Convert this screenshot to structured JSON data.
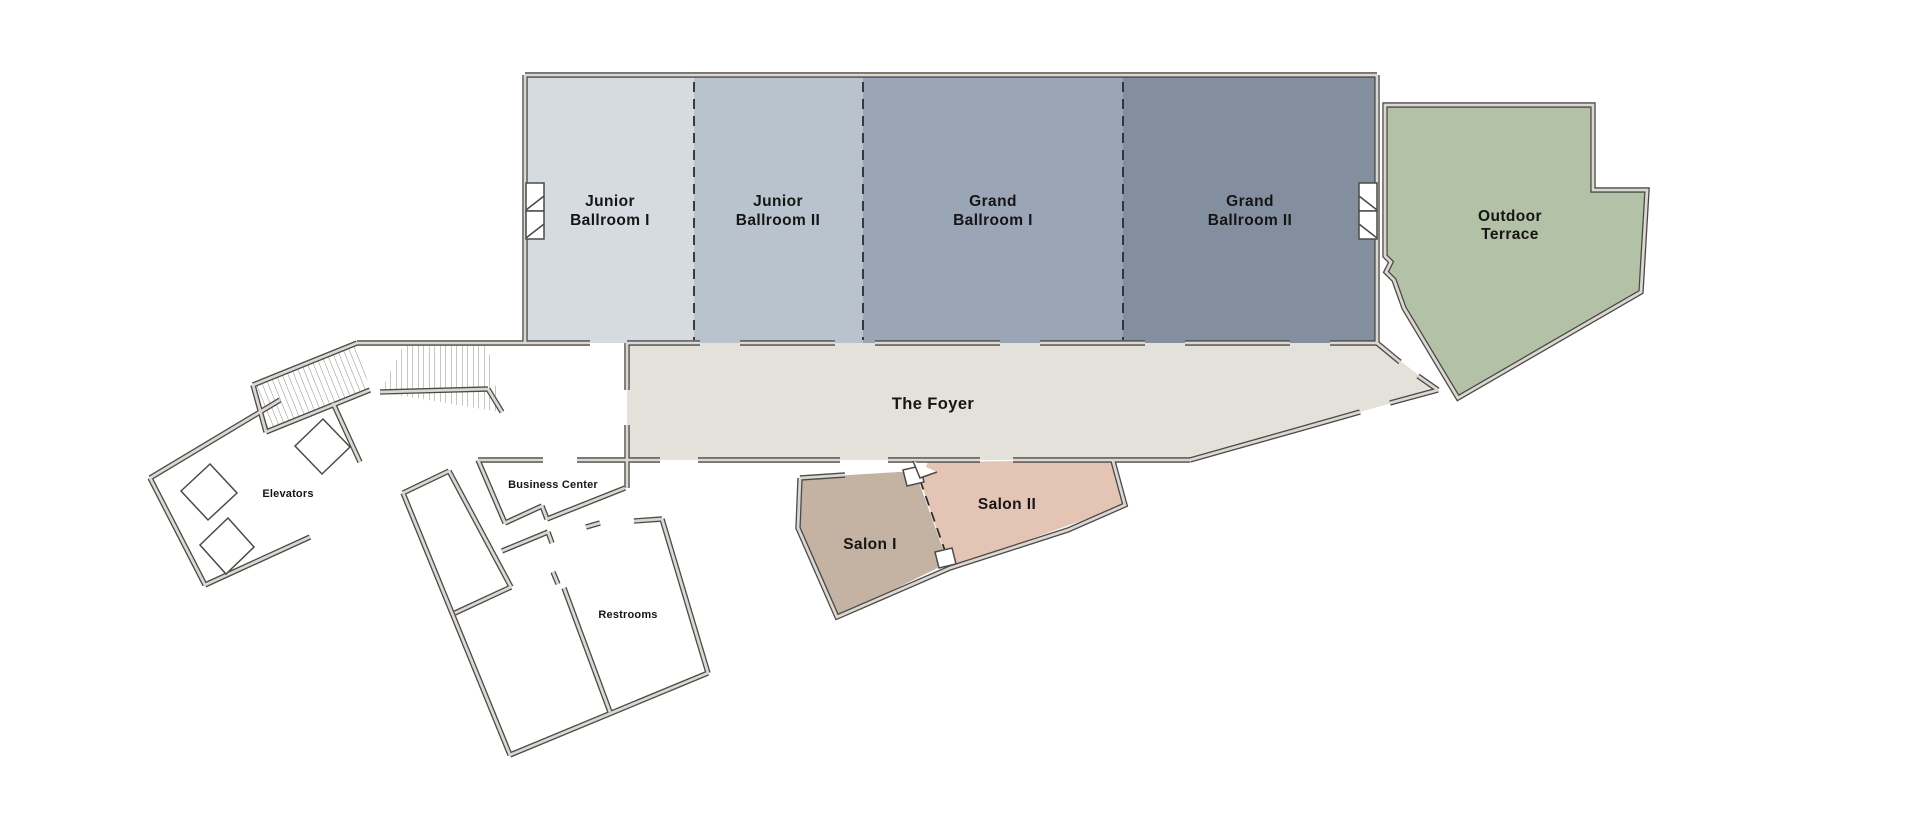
{
  "floor_plan": {
    "title": "Hotel event level floor plan",
    "rooms": {
      "junior_ballroom_1": {
        "label_line1": "Junior",
        "label_line2": "Ballroom I",
        "color": "#d6dbe2"
      },
      "junior_ballroom_2": {
        "label_line1": "Junior",
        "label_line2": "Ballroom II",
        "color": "#b9c3cd"
      },
      "grand_ballroom_1": {
        "label_line1": "Grand",
        "label_line2": "Ballroom I",
        "color": "#9aa5b5"
      },
      "grand_ballroom_2": {
        "label_line1": "Grand",
        "label_line2": "Ballroom II",
        "color": "#838e9e"
      },
      "outdoor_terrace": {
        "label_line1": "Outdoor",
        "label_line2": "Terrace",
        "color": "#b3c2a6"
      },
      "foyer": {
        "label": "The Foyer",
        "color": "#e4e1da"
      },
      "salon_1": {
        "label": "Salon I",
        "color": "#c4b3a3"
      },
      "salon_2": {
        "label": "Salon II",
        "color": "#e4c5b5"
      },
      "elevators": {
        "label": "Elevators"
      },
      "business_center": {
        "label": "Business Center"
      },
      "restrooms": {
        "label": "Restrooms"
      }
    }
  }
}
